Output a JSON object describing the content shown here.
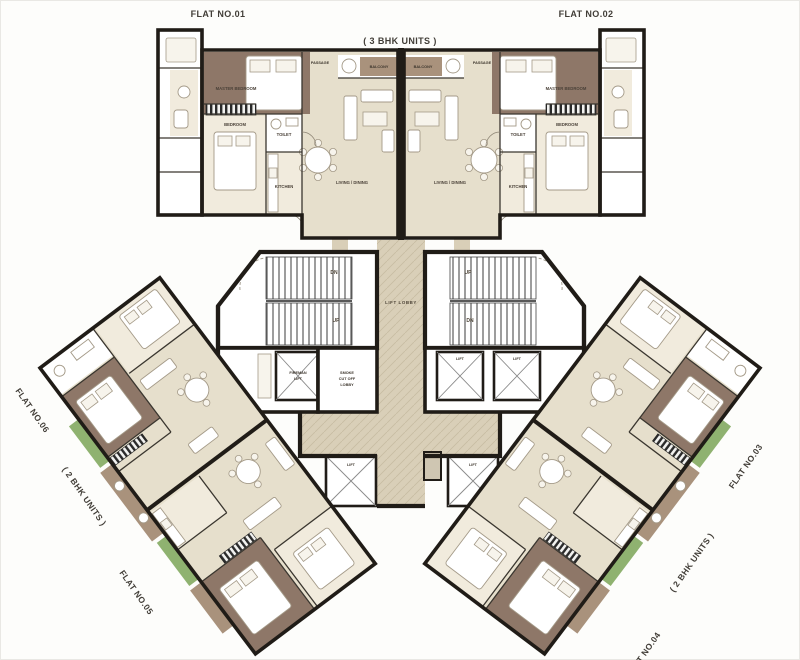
{
  "title": "Typical floor plan",
  "flats": {
    "f01": "FLAT NO.01",
    "f02": "FLAT NO.02",
    "f03": "FLAT NO.03",
    "f04": "FLAT NO.04",
    "f05": "FLAT NO.05",
    "f06": "FLAT NO.06"
  },
  "unit_types": {
    "top": "( 3 BHK UNITS )",
    "left": "( 2 BHK UNITS )",
    "right": "( 2 BHK UNITS )"
  },
  "core": {
    "lift_lobby": "LIFT LOBBY",
    "smoke_lobby_line1": "SMOKE",
    "smoke_lobby_line2": "CUT OFF",
    "smoke_lobby_line3": "LOBBY",
    "fireman_lift_line1": "FIREMAN",
    "fireman_lift_line2": "LIFT",
    "lift": "LIFT",
    "dn": "DN",
    "up": "UP"
  },
  "rooms": {
    "master_bedroom": "MASTER BEDROOM",
    "bedroom": "BEDROOM",
    "living_dining": "LIVING / DINING",
    "kitchen": "KITCHEN",
    "toilet": "TOILET",
    "passage": "PASSAGE",
    "balcony": "BALCONY"
  },
  "colors": {
    "bg": "#fdfdfb",
    "wall": "#201c17",
    "beige": "#e6dfcc",
    "beige_light": "#f1ebdd",
    "corridor": "#d9cfb8",
    "brown": "#8e7768",
    "brown_light": "#a9927c",
    "green": "#8fb270",
    "furn_line": "#a49a88",
    "label": "#413d37"
  }
}
